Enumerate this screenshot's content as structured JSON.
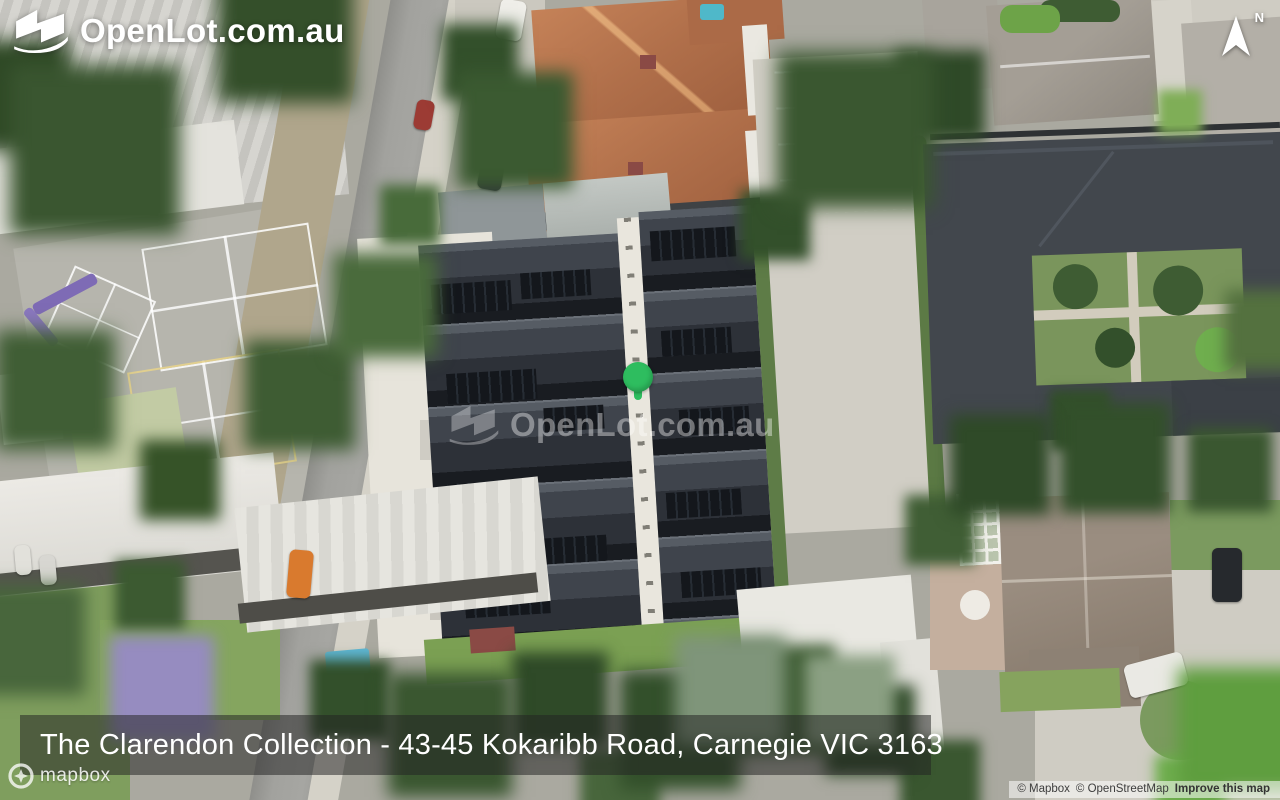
{
  "logo": {
    "text": "OpenLot.com.au"
  },
  "compass": {
    "label": "N"
  },
  "map": {
    "watermark_text": "OpenLot.com.au",
    "marker_color": "#2ebd5f"
  },
  "address_bar": {
    "text": "The Clarendon Collection - 43-45 Kokaribb Road, Carnegie VIC 3163"
  },
  "attribution": {
    "mapbox_wordmark": "mapbox",
    "links": [
      {
        "label": "© Mapbox"
      },
      {
        "label": "© OpenStreetMap"
      },
      {
        "label": "Improve this map"
      }
    ]
  }
}
